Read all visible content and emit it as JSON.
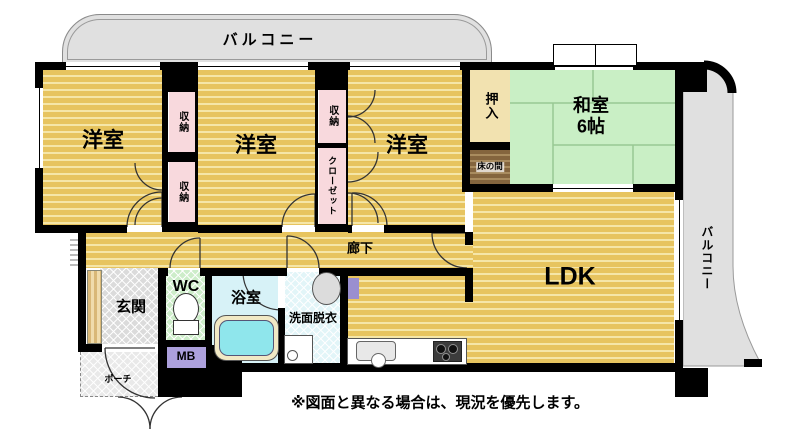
{
  "rooms": {
    "balcony_top": "バルコニー",
    "balcony_right": "バルコニー",
    "western_room_1": "洋室",
    "western_room_2": "洋室",
    "western_room_3": "洋室",
    "storage_1": "収納",
    "storage_2": "収納",
    "storage_3": "収納",
    "closet": "クローゼット",
    "oshiire": "押入",
    "tokonoma": "床の間",
    "japanese_room": "和室",
    "japanese_room_size": "6帖",
    "ldk": "LDK",
    "hallway": "廊下",
    "entrance": "玄関",
    "toilet": "WC",
    "bathroom": "浴室",
    "washroom": "洗面脱衣",
    "meter_box": "MB",
    "porch": "ポーチ"
  },
  "note": "※図面と異なる場合は、現況を優先します。",
  "colors": {
    "floor_wood": "#E7C45F",
    "floor_wood_light": "#F5E6A8",
    "tatami_green": "#C9EFC5",
    "closet_pink": "#F8D9DD",
    "oshiire_beige": "#F2E2B0",
    "tokonoma_brown": "#84653E",
    "balcony_gray": "#E0E0E0",
    "wc_green": "#CDEDC9",
    "bath_cyan": "#D7F2F7",
    "washroom_cyan": "#E2F5F8",
    "mb_purple": "#ACA0DC",
    "wall": "#000000"
  }
}
